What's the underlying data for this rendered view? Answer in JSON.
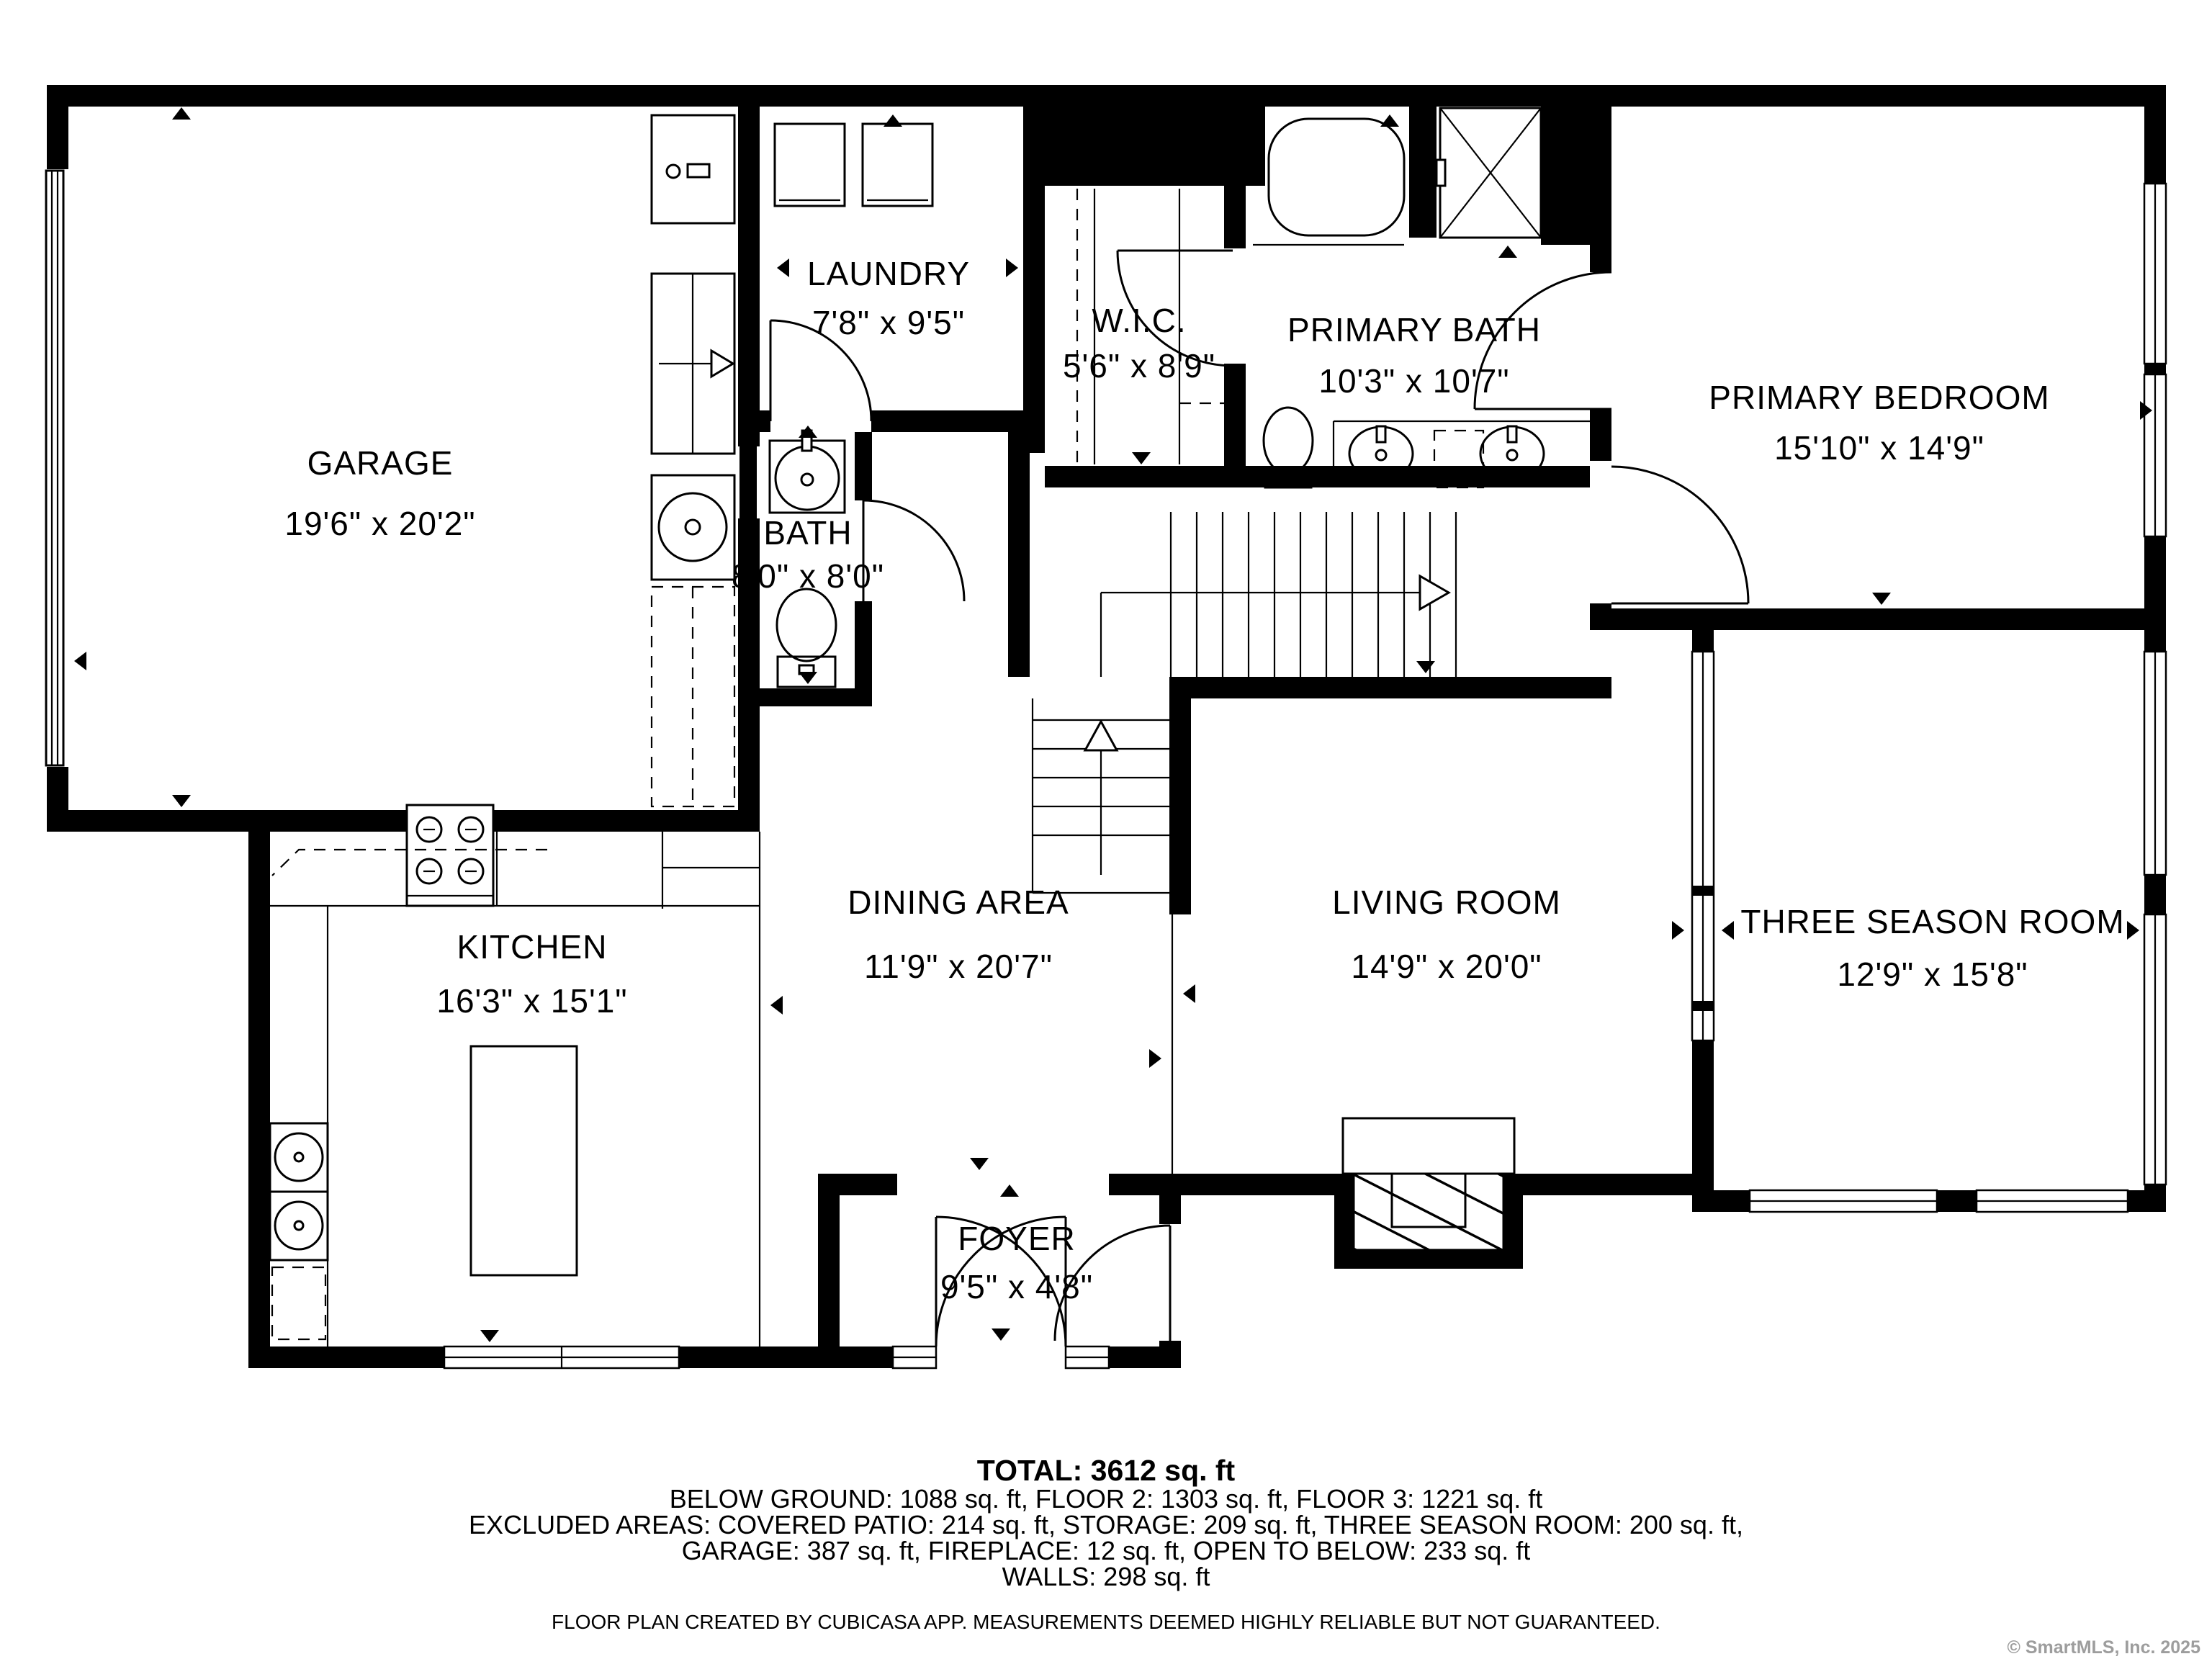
{
  "title": "Floor plan",
  "colors": {
    "wall": "#000000",
    "background": "#ffffff",
    "copyright_gray": "#9d9d9d"
  },
  "rooms": {
    "garage": {
      "name": "GARAGE",
      "dims": "19'6\" x 20'2\""
    },
    "laundry": {
      "name": "LAUNDRY",
      "dims": "7'8\" x 9'5\""
    },
    "wic": {
      "name": "W.I.C.",
      "dims": "5'6\" x 8'9\""
    },
    "primary_bath": {
      "name": "PRIMARY BATH",
      "dims": "10'3\" x 10'7\""
    },
    "primary_bedroom": {
      "name": "PRIMARY BEDROOM",
      "dims": "15'10\" x 14'9\""
    },
    "bath": {
      "name": "BATH",
      "dims": "8'0\" x 8'0\""
    },
    "kitchen": {
      "name": "KITCHEN",
      "dims": "16'3\" x 15'1\""
    },
    "dining": {
      "name": "DINING AREA",
      "dims": "11'9\" x 20'7\""
    },
    "living": {
      "name": "LIVING ROOM",
      "dims": "14'9\" x 20'0\""
    },
    "three_season": {
      "name": "THREE SEASON ROOM",
      "dims": "12'9\" x 15'8\""
    },
    "foyer": {
      "name": "FOYER",
      "dims": "9'5\" x 4'8\""
    }
  },
  "summary": {
    "total": "TOTAL: 3612 sq. ft",
    "line1": "BELOW GROUND: 1088 sq. ft, FLOOR 2: 1303 sq. ft, FLOOR 3: 1221 sq. ft",
    "line2": "EXCLUDED AREAS: COVERED PATIO: 214 sq. ft, STORAGE: 209 sq. ft, THREE SEASON ROOM: 200 sq. ft,",
    "line3": "GARAGE: 387 sq. ft, FIREPLACE: 12 sq. ft, OPEN TO BELOW: 233 sq. ft",
    "line4": "WALLS: 298 sq. ft"
  },
  "disclaimer": "FLOOR PLAN CREATED BY CUBICASA APP. MEASUREMENTS DEEMED HIGHLY RELIABLE BUT NOT GUARANTEED.",
  "copyright": "© SmartMLS, Inc.  2025",
  "icons": {
    "fixtures": [
      "bathtub",
      "shower",
      "toilet",
      "sink",
      "double-vanity",
      "washer",
      "dryer",
      "range",
      "refrigerator",
      "kitchen-island",
      "fireplace",
      "water-heater",
      "stairs-up",
      "stairs-down",
      "garage-door",
      "front-double-door",
      "interior-door",
      "window"
    ]
  }
}
